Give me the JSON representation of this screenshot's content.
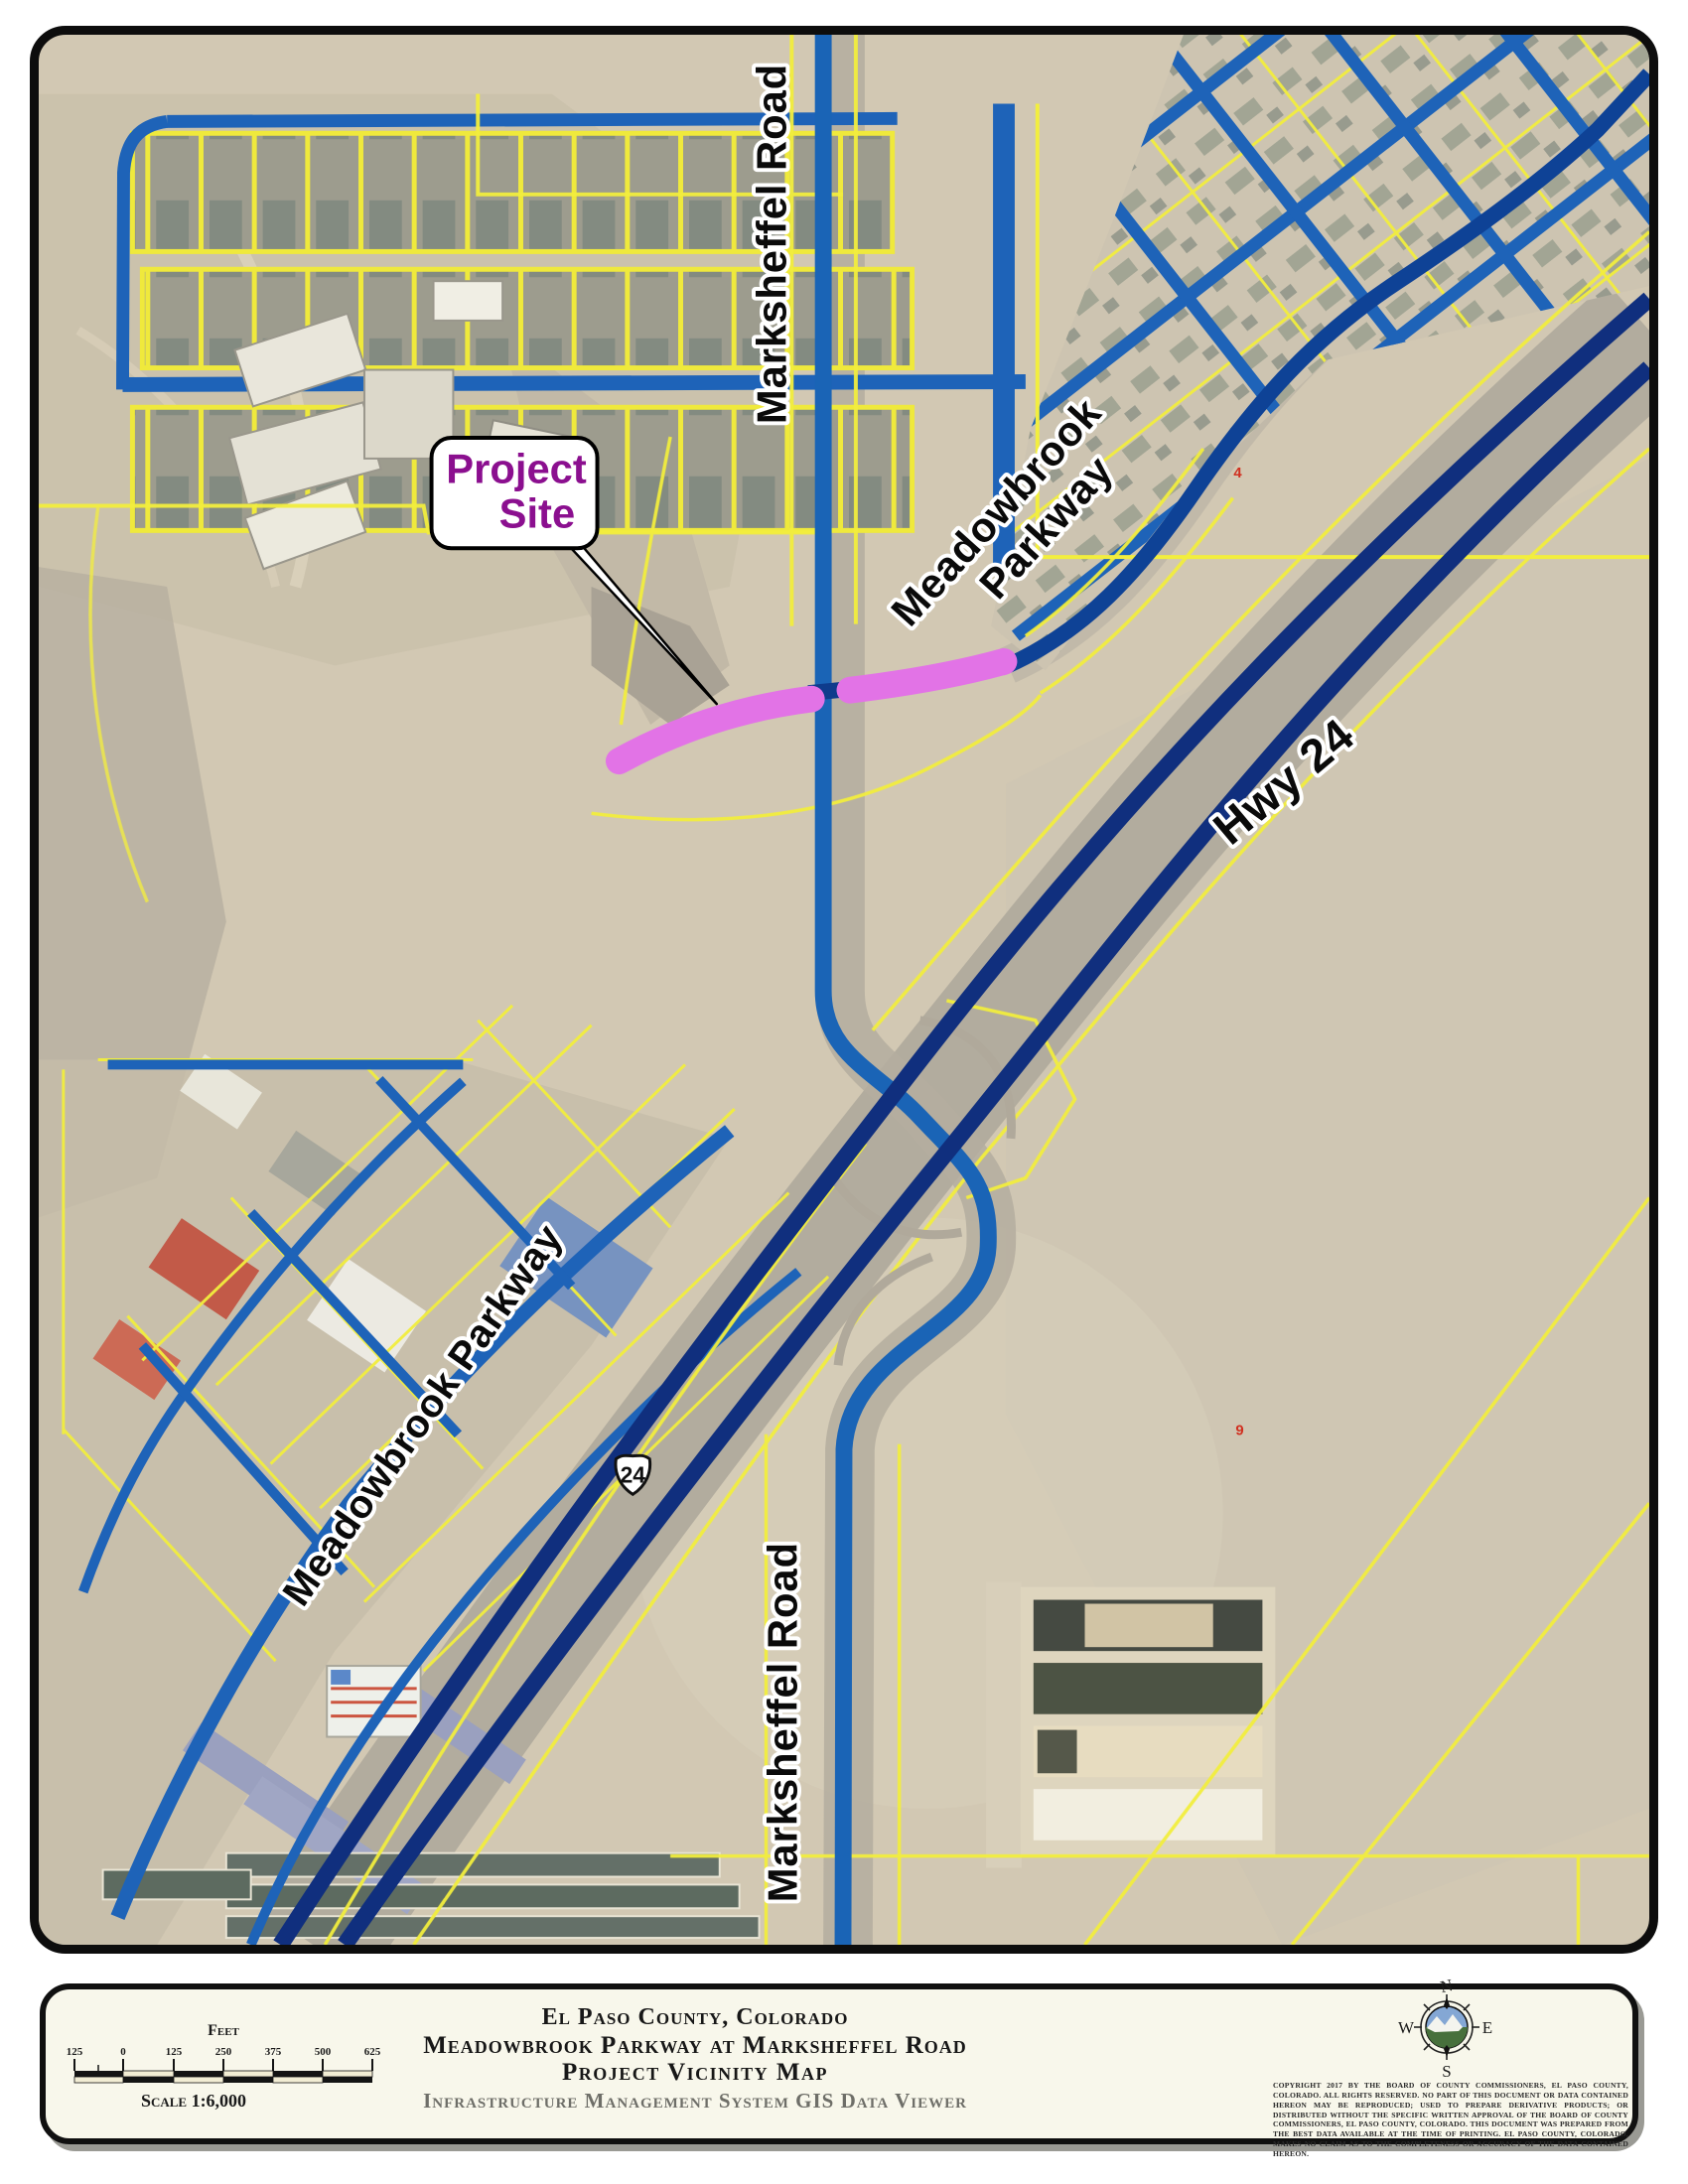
{
  "colors": {
    "road_blue": "#1a60b2",
    "highway_navy": "#102f7e",
    "parcel_yellow": "#f2ee3e",
    "project_pink": "#e273e6",
    "callout_purple": "#8b0f8f",
    "marker_red": "#d03020"
  },
  "map": {
    "road_labels": {
      "marksheffel_top": "Marksheffel Road",
      "marksheffel_bottom": "Marksheffel Road",
      "meadowbrook_ne": {
        "line1": "Meadowbrook",
        "line2": "Parkway"
      },
      "meadowbrook_sw": "Meadowbrook Parkway",
      "hwy24": "Hwy 24"
    },
    "highway_shield": "24",
    "callout": {
      "line1": "Project",
      "line2": "Site"
    },
    "markers": {
      "lot4": "4",
      "lot9": "9"
    }
  },
  "footer": {
    "title_line1": "El Paso County, Colorado",
    "title_line2": "Meadowbrook Parkway at Marksheffel Road",
    "title_line3": "Project Vicinity Map",
    "subtitle": "Infrastructure Management System GIS Data Viewer",
    "scalebar": {
      "unit_label": "Feet",
      "ticks": [
        "125",
        "0",
        "125",
        "250",
        "375",
        "500",
        "625"
      ],
      "scale_text": "Scale 1:6,000"
    },
    "compass": {
      "north": "N",
      "east": "E",
      "south": "S",
      "west": "W"
    },
    "copyright": "Copyright 2017 by the Board of County Commissioners, El Paso County, Colorado. All rights reserved. No part of this document or data contained hereon may be reproduced; used to prepare derivative products; or distributed without the specific written approval of the Board of County Commissioners, El Paso County, Colorado. This document was prepared from the best data available at the time of printing. El Paso County, Colorado, makes no claim as to the completeness or accuracy of the data contained hereon."
  }
}
